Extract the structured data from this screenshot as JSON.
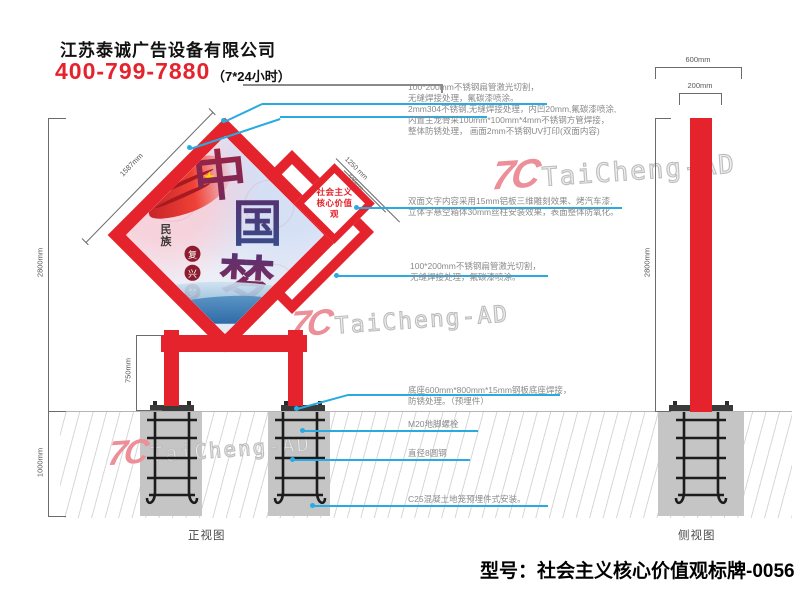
{
  "header": {
    "company": "江苏泰诚广告设备有限公司",
    "phone": "400-799-7880",
    "hours": "（7*24小时）"
  },
  "watermark": {
    "logo": "7C",
    "text": "TaiCheng-AD"
  },
  "front_view": {
    "label": "正视图",
    "sign_text": {
      "line1": "社会主义",
      "line2": "核心价值观"
    },
    "artwork": {
      "char1": "中",
      "char2": "国",
      "char3": "梦",
      "side_text": "民族",
      "seal_chars": [
        "复",
        "兴",
        "梦"
      ]
    },
    "dims": {
      "height_above_ground": "2800mm",
      "foundation_depth": "1000mm",
      "leg_height": "750mm",
      "panel_side": "1587mm",
      "mid_panel_side": "1250 mm",
      "small_panel_side": "530mm"
    }
  },
  "side_view": {
    "label": "侧视图",
    "dims": {
      "base_width": "600mm",
      "pole_width": "200mm",
      "height": "2800mm"
    }
  },
  "callouts": [
    {
      "lines": [
        "100*200mm不锈钢扁管激光切割，",
        "无缝焊接处理，氟碳漆喷涂。"
      ]
    },
    {
      "lines": [
        "2mm304不锈钢,无缝焊接处理，内凹20mm,氟碳漆喷涂,",
        "内置主龙骨采100mm*100mm*4mm不锈钢方管焊接，",
        "整体防锈处理， 画面2mm不锈钢UV打印(双面内容)"
      ]
    },
    {
      "lines": [
        "双面文字内容采用15mm铝板三维雕刻效果、烤汽车漆,",
        "立体字悬空箱体30mm丝柱安装效果，表面整体防氧化。"
      ]
    },
    {
      "lines": [
        "100*200mm不锈钢扁管激光切割，",
        "无缝焊接处理，氟碳漆喷涂。"
      ]
    },
    {
      "lines": [
        "底座600mm*800mm*15mm钢板底座焊接，",
        "防锈处理。（预埋件）"
      ]
    },
    {
      "lines": [
        "M20地脚螺栓"
      ]
    },
    {
      "lines": [
        "直径8圆钢"
      ]
    },
    {
      "lines": [
        "C25混凝土地笼预埋件式安装。"
      ]
    }
  ],
  "footer": {
    "model": "型号：社会主义核心价值观标牌-0056"
  },
  "colors": {
    "accent_red": "#e5232c",
    "leader_blue": "#29abe2",
    "concrete_gray": "#c5c5c5",
    "watermark_pink": "#ec8f98",
    "dim_gray": "#595757"
  }
}
